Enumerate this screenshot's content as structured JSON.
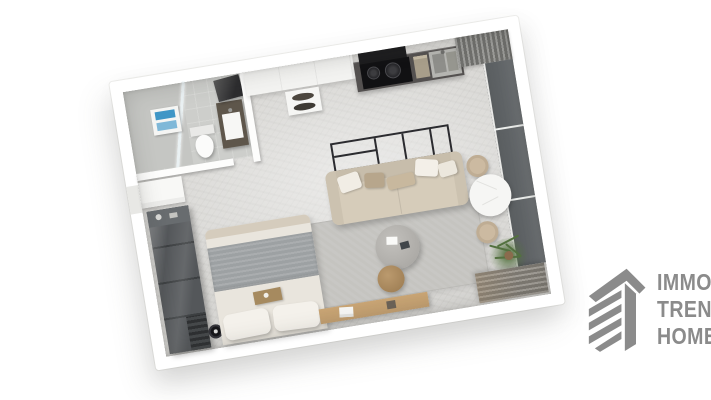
{
  "scene": {
    "description": "Top-down 3D render of a studio apartment floor plan on a white background",
    "background": "#ffffff"
  },
  "brand": {
    "line1": "IMMO",
    "line2": "TREND",
    "line3": "HOME",
    "icon": "building-logo-icon"
  },
  "colors": {
    "brand_gray": "#8b8b8b",
    "wall_white": "#ffffff",
    "floor_gray": "#d9d8d5",
    "bathroom_floor": "#cdcecb",
    "counter_dark": "#545150",
    "appliance_black": "#111113",
    "steel": "#b5b5b1",
    "window_glass": "#63676a",
    "wardrobe_dark": "#54575a",
    "sofa_beige": "#d6ccba",
    "cushion_tan": "#b7a68c",
    "rug_gray": "#c5c4c0",
    "blanket_gray": "#9da1a3",
    "wood_tan": "#bf9c6e",
    "marble_white": "#f6f6f4",
    "towel_blue": "#3f96c6",
    "plant_green": "#53713f",
    "frame_black": "#2b2b2f"
  },
  "plan": {
    "rotation_deg": -9.3,
    "rooms": [
      {
        "id": "bathroom",
        "features": [
          "shower-glass",
          "towel-stack",
          "toilet",
          "vanity-sink",
          "mirror"
        ]
      },
      {
        "id": "entry",
        "features": [
          "entry-door-recess",
          "entry-closet"
        ]
      },
      {
        "id": "kitchen",
        "features": [
          "tall-cabinets",
          "bowl-shelf",
          "range-hood",
          "cooktop",
          "coffee-machine",
          "double-sink",
          "dark-counter"
        ]
      },
      {
        "id": "living-dining",
        "features": [
          "metal-frame-shelf",
          "sofa-with-cushions",
          "area-rug",
          "round-coffee-table",
          "wood-side-table",
          "round-marble-dining-table",
          "two-chairs",
          "plant",
          "wood-sideboard"
        ]
      },
      {
        "id": "sleeping-area",
        "features": [
          "glass-wardrobe",
          "double-bed",
          "knit-blanket",
          "two-pillows",
          "bed-tray",
          "floor-fan"
        ]
      },
      {
        "id": "window-wall",
        "features": [
          "floor-to-ceiling-glazing",
          "corner-louver-panel",
          "louver-bench"
        ]
      }
    ]
  }
}
